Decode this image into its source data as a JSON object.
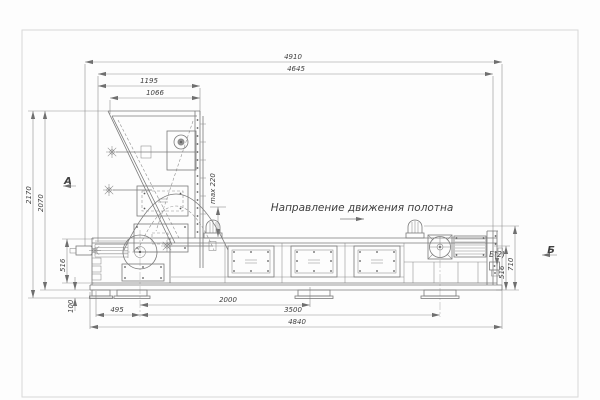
{
  "meta": {
    "background": "#fdfdfd",
    "frame_color": "#d8d8d8",
    "machine_line_color": "#7a7a7a",
    "dimension_line_color": "#8f8f8f",
    "text_color": "#3f3f3f"
  },
  "labels": {
    "direction": "Направление движения полотна",
    "view_a": "А",
    "view_b": "Б",
    "detail_b": "Б(2)",
    "max_gap": "max 220"
  },
  "dimensions": {
    "top": [
      "4910",
      "4645",
      "1195",
      "1066"
    ],
    "left": [
      "2170",
      "2070",
      "516",
      "100"
    ],
    "bottom": [
      "2000",
      "495",
      "3500",
      "4840"
    ],
    "right": [
      "516",
      "710"
    ]
  }
}
